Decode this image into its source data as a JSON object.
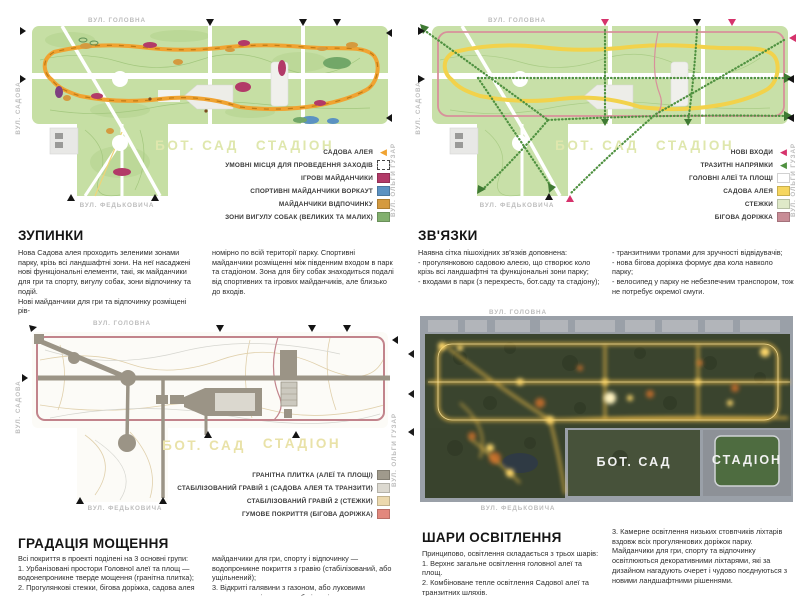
{
  "streets": {
    "holovna": "ВУЛ. ГОЛОВНА",
    "sadova": "ВУЛ. САДОВА",
    "fedkovycha": "ВУЛ. ФЕДЬКОВИЧА",
    "huzar": "ВУЛ. ОЛЬГИ ГУЗАР"
  },
  "map_labels": {
    "bot_sad": "БОТ. САД",
    "stadion": "СТАДІОН"
  },
  "sections": {
    "stops": {
      "title": "ЗУПИНКИ",
      "col1": "Нова Садова алея проходить зеленими зонами парку, крізь всі ландшафтні зони. На неї насаджені нові функціональні елементи, такі, як майданчики для гри та спорту, вигулу собак, зони відпочинку та подій.\nНові майданчики для гри та відпочинку розміщені рів-",
      "col2": "номірно по всій території парку. Спортивні майданчики розміщенні між південним входом в парк та стадіоном. Зона для бігу собак знаходиться подалі від спортивних та ігрових майданчиків, але близько до входів.",
      "legend": [
        {
          "label": "САДОВА АЛЕЯ",
          "color": "#f0a331"
        },
        {
          "label": "УМОВНІ МІСЦЯ ДЛЯ ПРОВЕДЕННЯ ЗАХОДІВ",
          "color": "#ffffff"
        },
        {
          "label": "ІГРОВІ МАЙДАНЧИКИ",
          "color": "#b23a68"
        },
        {
          "label": "СПОРТИВНІ МАЙДАНЧИКИ ВОРКАУТ",
          "color": "#5b92c2"
        },
        {
          "label": "МАЙДАНЧИКИ ВІДПОЧИНКУ",
          "color": "#d49a3f"
        },
        {
          "label": "ЗОНИ ВИГУЛУ СОБАК (ВЕЛИКИХ ТА МАЛИХ)",
          "color": "#82b06e"
        }
      ]
    },
    "links": {
      "title": "ЗВ'ЯЗКИ",
      "col1": "Наявна сітка пішохідних зв'язків доповнена:\n- прогулянковою садовою алеєю, що створює коло крізь всі ландшафтні та функціональні зони парку;\n- входами в парк (з перехресть, бот.саду та стадіону);",
      "col2": "- транзитними тропами для зручності відвідувачів;\n- нова бігова доріжка формує два кола навколо парку;\n- велосипед у парку не небезпечним транспором, тож не потребує окремої смуги.",
      "legend": [
        {
          "label": "НОВІ ВХОДИ",
          "color": "#d6336c"
        },
        {
          "label": "ТРАЗИТНІ НАПРЯМКИ",
          "color": "#4f9140"
        },
        {
          "label": "ГОЛОВНІ АЛЕЇ ТА ПЛОЩІ",
          "color": "#ffffff"
        },
        {
          "label": "САДОВА АЛЕЯ",
          "color": "#f6d65f"
        },
        {
          "label": "СТЕЖКИ",
          "color": "#dfe9c8"
        },
        {
          "label": "БІГОВА ДОРІЖКА",
          "color": "#c88c96"
        }
      ]
    },
    "paving": {
      "title": "ГРАДАЦІЯ МОЩЕННЯ",
      "col1": "Всі покриття в проекті  поділені на 3 основні групи:\n1. Урбанізовані простори Головної  алеї  та площ — водонепроникне тверде мощення (гранітна плитка);\n2. Прогулянкові стежки, бігова доріжка,  садова алея та",
      "col2": "майданчики для гри, спорту і відпочинку — водопроникне покриття з гравію (стабілізований, або ущільнений);\n3. Відкриті галявини з газоном, або луковими травами для відпочинку, або івентів.",
      "legend": [
        {
          "label": "ГРАНІТНА ПЛИТКА (АЛЕЇ ТА ПЛОЩІ)",
          "color": "#a09a8c"
        },
        {
          "label": "СТАБІЛІЗОВАНИЙ ГРАВІЙ 1 (САДОВА АЛЕЯ ТА ТРАНЗИТИ)",
          "color": "#dcd9d0"
        },
        {
          "label": "СТАБІЛІЗОВАНИЙ ГРАВІЙ 2 (СТЕЖКИ)",
          "color": "#ecd9ae"
        },
        {
          "label": "ГУМОВЕ ПОКРИТТЯ (БІГОВА ДОРІЖКА)",
          "color": "#e2887d"
        }
      ]
    },
    "lighting": {
      "title": "ШАРИ ОСВІТЛЕННЯ",
      "col1": "Принципово, освітлення складається з трьох шарів:\n1. Верхнє загальне освітлення головної алеї та площ.\n2. Комбіноване тепле освітлення Садової алеї та транзитних шляхів.",
      "col2": "3. Камерне освітлення низьких стовпчиків ліхтарів вздовж всіх прогулянкових доріжок парку.\nМайданчики для гри, спорту та відпочинку освітлюються декоративними ліхтарями, які за дизайном нагадують очерет і чудово поєднуються з новими ландшафтними рішеннями."
    }
  }
}
